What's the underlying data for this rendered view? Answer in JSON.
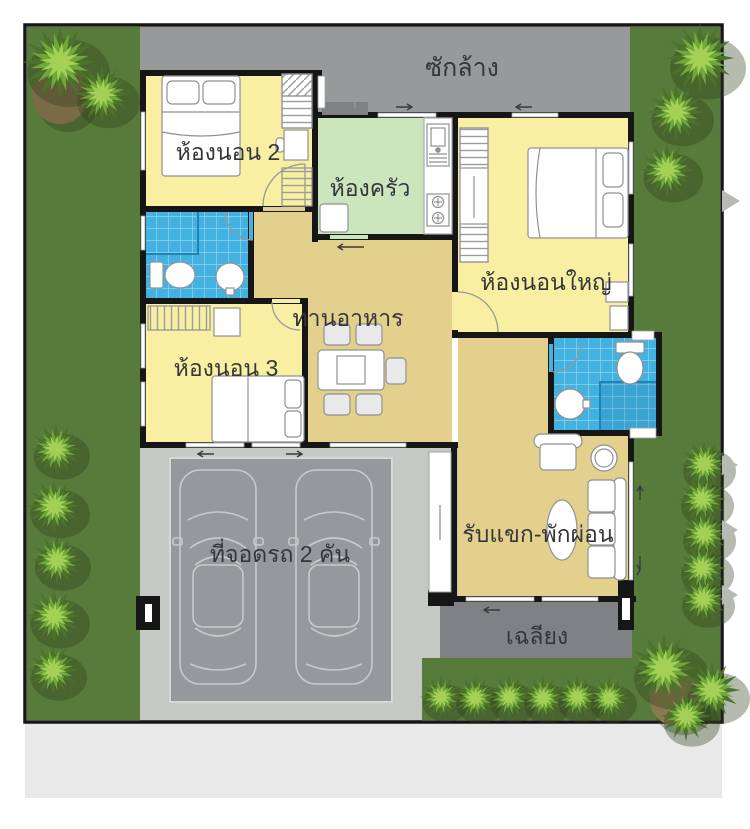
{
  "plan": {
    "rooms": {
      "laundry": "ซักล้าง",
      "bedroom2": "ห้องนอน 2",
      "kitchen": "ห้องครัว",
      "master_bedroom": "ห้องนอนใหญ่",
      "dining": "ทานอาหาร",
      "bedroom3": "ห้องนอน 3",
      "living": "รับแขก-พักผ่อน",
      "garage": "ที่จอดรถ 2 คัน",
      "porch": "เฉลียง"
    },
    "colors": {
      "bedroom_floor": "#f9efa2",
      "living_dining_floor": "#e3d08d",
      "kitchen_floor": "#cbe5bd",
      "bathroom_tile": "#44b2e0",
      "lawn": "#567b3a",
      "laundry_concrete": "#98999b",
      "driveway": "#c6c8c5",
      "garage_slab": "#96989b",
      "porch_concrete": "#7f8184",
      "walls": "#161616",
      "sidewalk": "#e9e9e9"
    }
  }
}
